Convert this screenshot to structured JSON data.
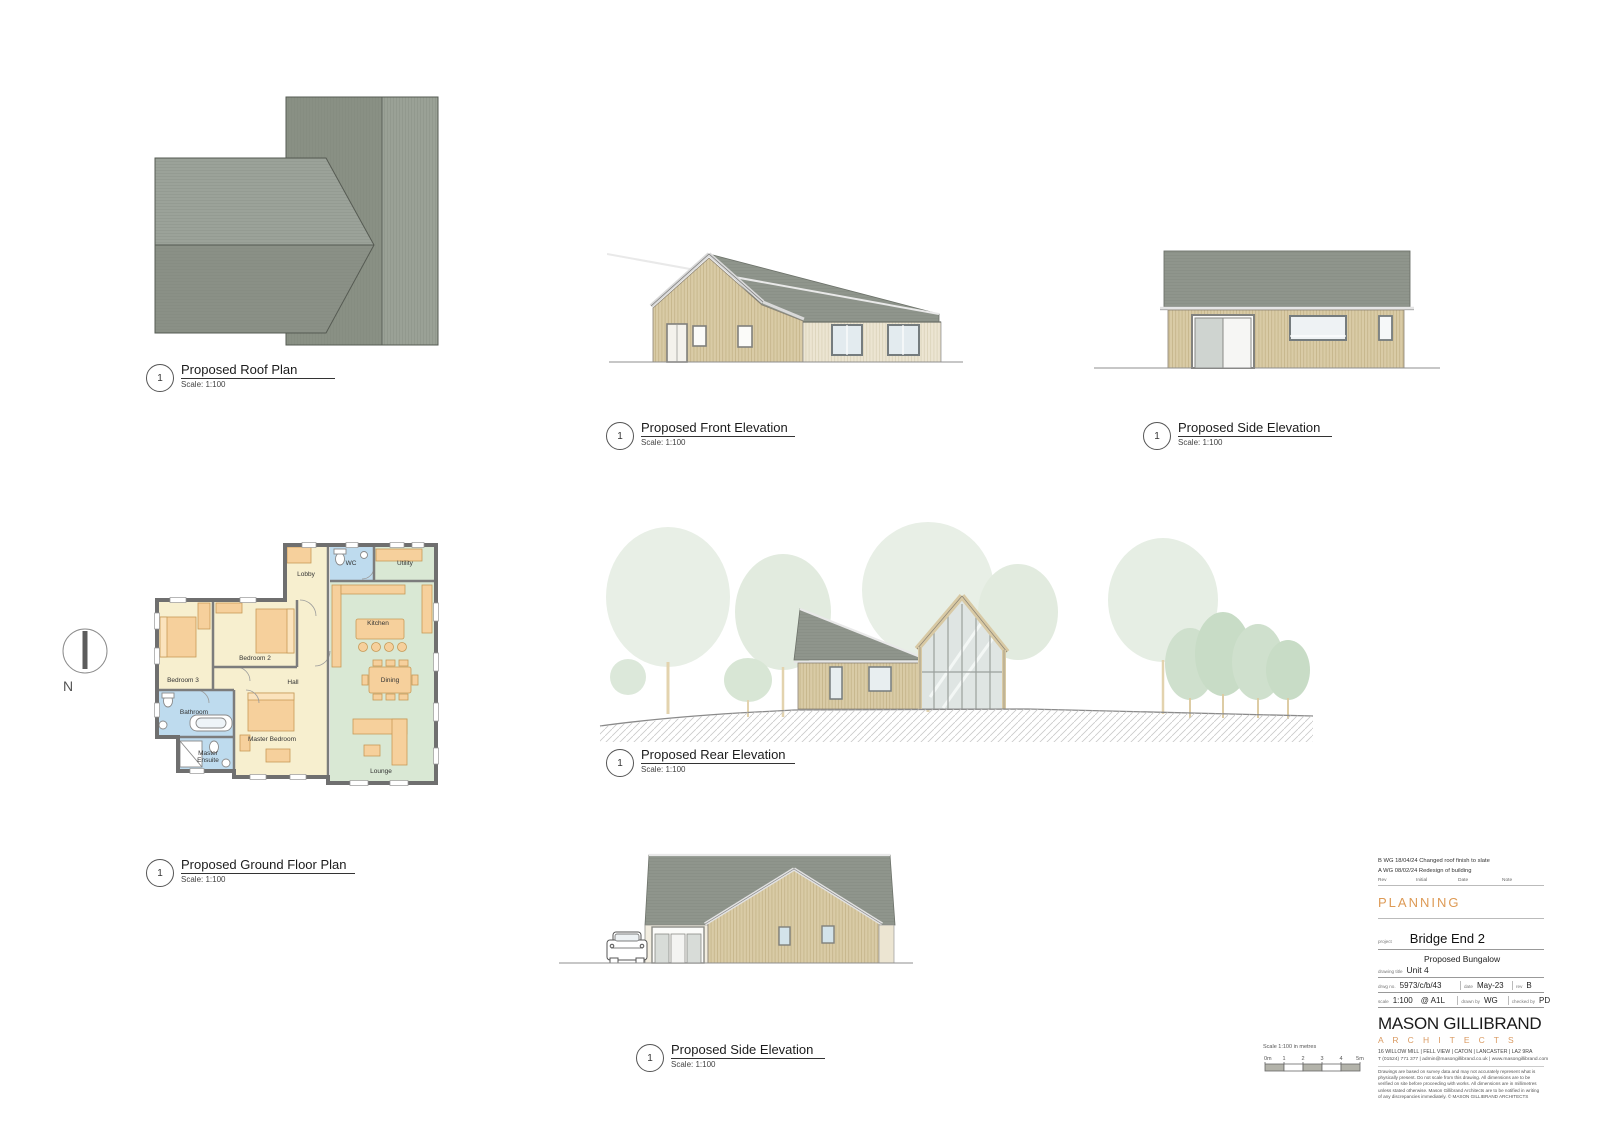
{
  "sheet": {
    "north_label": "N"
  },
  "labels": {
    "roof_plan": {
      "num": "1",
      "title": "Proposed Roof Plan",
      "scale": "Scale: 1:100"
    },
    "front_elevation": {
      "num": "1",
      "title": "Proposed Front Elevation",
      "scale": "Scale: 1:100"
    },
    "side_elevation_top": {
      "num": "1",
      "title": "Proposed Side Elevation",
      "scale": "Scale: 1:100"
    },
    "rear_elevation": {
      "num": "1",
      "title": "Proposed Rear Elevation",
      "scale": "Scale: 1:100"
    },
    "ground_floor_plan": {
      "num": "1",
      "title": "Proposed Ground Floor Plan",
      "scale": "Scale: 1:100"
    },
    "side_elevation_bottom": {
      "num": "1",
      "title": "Proposed Side Elevation",
      "scale": "Scale: 1:100"
    }
  },
  "floor_plan_rooms": {
    "lobby": "Lobby",
    "wc": "WC",
    "utility": "Utility",
    "kitchen": "Kitchen",
    "dining": "Dining",
    "lounge": "Lounge",
    "bedroom2": "Bedroom 2",
    "bedroom3": "Bedroom 3",
    "hall": "Hall",
    "bathroom": "Bathroom",
    "master_bedroom": "Master Bedroom",
    "master_ensuite_1": "Master",
    "master_ensuite_2": "Ensuite"
  },
  "scale_bar": {
    "caption": "Scale 1:100 in metres",
    "ticks": [
      "0m",
      "1",
      "2",
      "3",
      "4",
      "5m"
    ]
  },
  "title_block": {
    "revisions": [
      {
        "text": "B WG 18/04/24 Changed roof finish to slate"
      },
      {
        "text": "A WG 08/02/24 Redesign of building"
      }
    ],
    "rev_header": {
      "rev": "Rev",
      "initial": "Initial",
      "date": "Date",
      "note": "Note"
    },
    "status": "PLANNING",
    "project_label": "project",
    "project": "Bridge End 2",
    "subtitle": "Proposed Bungalow",
    "drawing_title_label": "drawing title",
    "drawing_title": "Unit 4",
    "drwg_no_label": "drwg  no.",
    "drwg_no": "5973/c/b/43",
    "date_label": "date",
    "date": "May-23",
    "rev_label": "rev",
    "rev": "B",
    "scale_label": "scale",
    "scale": "1:100",
    "paper": "@ A1L",
    "drawn_by_label": "drawn by",
    "drawn_by": "WG",
    "checked_by_label": "checked by",
    "checked_by": "PD",
    "firm_name": "MASON GILLIBRAND",
    "firm_sub": "A R C H I T E C T S",
    "address": "16  WILLOW MILL | FELL VIEW | CATON | LANCASTER | LA2  9RA",
    "contact": "T  (01524) 771 377 | admin@masongillibrand.co.uk | www.masongillibrand.com",
    "disclaimer": "Drawings are based on survey data and may not accurately represent what is physically present. Do not scale from this drawing. All dimensions are to be verified on site before proceeding with works. All dimensions are in millimetres unless stated otherwise. Mason Gillibrand Architects are to be notified in writing of any discrepancies immediately. © MASON GILLIBRAND ARCHITECTS"
  },
  "colors": {
    "accent_orange": "#dd9a55",
    "roof_gray": "#8f958c",
    "cladding_tan": "#d8c9a4",
    "plan_cream": "#f7efcf",
    "plan_green": "#d9e8d4",
    "plan_blue": "#bedbee",
    "furniture_tan": "#f6d09c"
  }
}
